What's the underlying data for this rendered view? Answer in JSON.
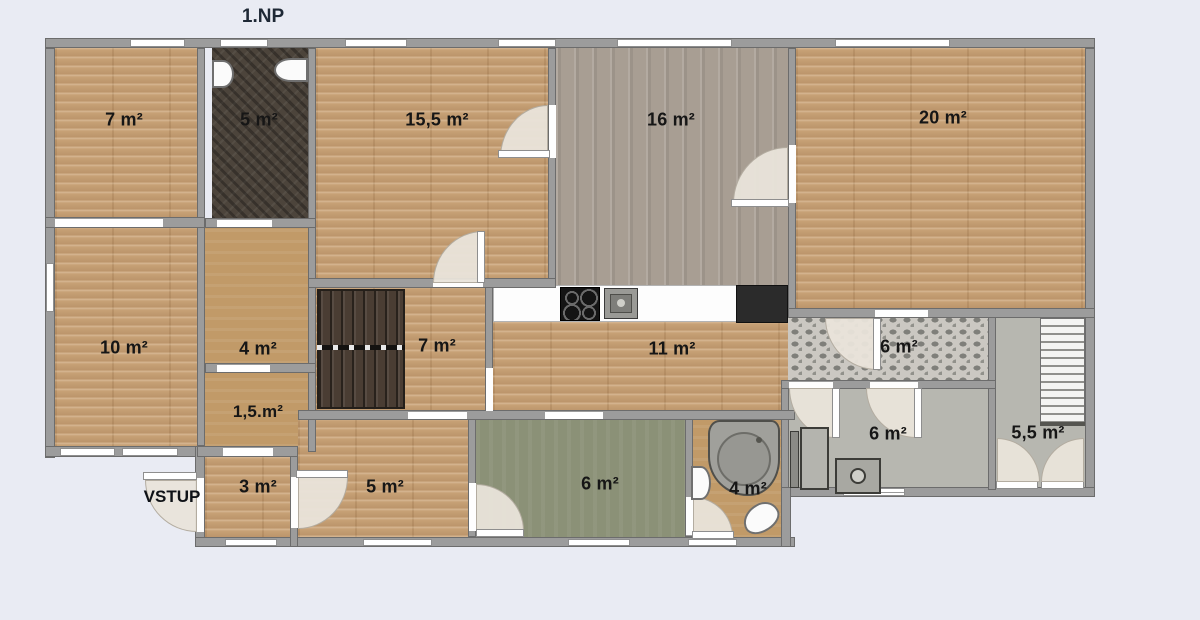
{
  "title": "1.NP",
  "entrance": {
    "label": "VSTUP"
  },
  "rooms": {
    "r7_top": {
      "label": "7 m²"
    },
    "r5_bath": {
      "label": "5 m²"
    },
    "r155": {
      "label": "15,5 m²"
    },
    "r16": {
      "label": "16 m²"
    },
    "r20": {
      "label": "20 m²"
    },
    "r10": {
      "label": "10 m²"
    },
    "r4": {
      "label": "4 m²"
    },
    "r7_mid": {
      "label": "7 m²"
    },
    "r11": {
      "label": "11 m²"
    },
    "r6_tiled": {
      "label": "6 m²"
    },
    "r15": {
      "label": "1,5.m²"
    },
    "r3": {
      "label": "3 m²"
    },
    "r5": {
      "label": "5 m²"
    },
    "r6_green": {
      "label": "6 m²"
    },
    "r4_bath": {
      "label": "4 m²"
    },
    "r6_util": {
      "label": "6 m²"
    },
    "r55_stairs": {
      "label": "5,5 m²"
    }
  },
  "colors": {
    "background": "#e9ebf3",
    "wall": "#9c9c9c",
    "wood_light": "#c7a176",
    "wood_gray": "#a89e93",
    "dark_floor": "#4c443b",
    "tan_floor": "#c19a68",
    "green_floor": "#8b9177",
    "gray_floor": "#b7b7b0",
    "tile_base": "#cbc8c2",
    "door_arc": "#e9e4da",
    "label_text": "#161616"
  }
}
